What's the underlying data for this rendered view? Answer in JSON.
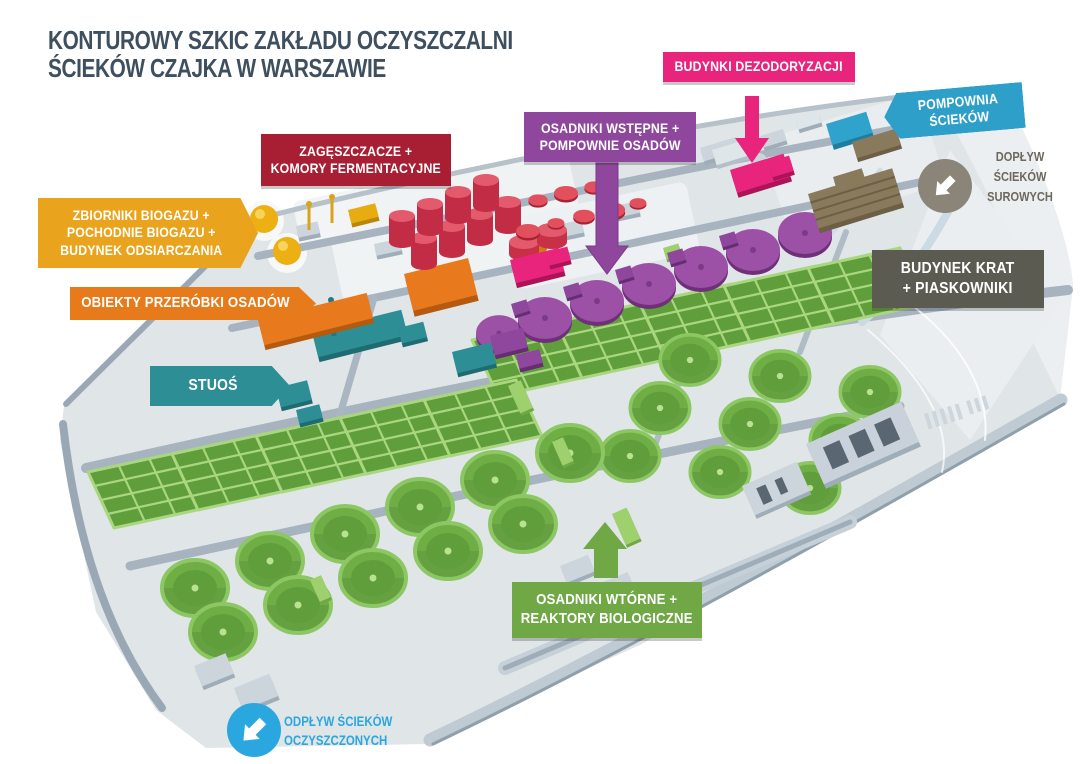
{
  "title": {
    "text": "KONTUROWY SZKIC ZAKŁADU OCZYSZCZALNI ŚCIEKÓW CZAJKA W WARSZAWIE",
    "lines": [
      "KONTUROWY SZKIC ZAKŁADU OCZYSZCZALNI",
      "ŚCIEKÓW CZAJKA W WARSZAWIE"
    ],
    "color": "#3e4f60"
  },
  "labels": {
    "dezodoryzacja": {
      "lines": [
        "BUDYNKI DEZODORYZACJI"
      ],
      "color": "#e8247c"
    },
    "pompownia": {
      "lines": [
        "POMPOWNIA",
        "ŚCIEKÓW"
      ],
      "color": "#2d9fc9"
    },
    "doplyw": {
      "lines": [
        "DOPŁYW",
        "ŚCIEKÓW",
        "SUROWYCH"
      ],
      "color": "#8b8478",
      "text_color": "#6e675c"
    },
    "osadniki_wstepne": {
      "lines": [
        "OSADNIKI WSTĘPNE +",
        "POMPOWNIE OSADÓW"
      ],
      "color": "#8f479e"
    },
    "zageszczacze": {
      "lines": [
        "ZAGĘSZCZACZE +",
        "KOMORY FERMENTACYJNE"
      ],
      "color": "#a81e33"
    },
    "zbiorniki": {
      "lines": [
        "ZBIORNIKI BIOGAZU +",
        "POCHODNIE BIOGAZU +",
        "BUDYNEK ODSIARCZANIA"
      ],
      "color": "#e9a31d"
    },
    "obiekty": {
      "lines": [
        "OBIEKTY PRZERÓBKI OSADÓW"
      ],
      "color": "#e77a1a"
    },
    "stuos": {
      "lines": [
        "STUOŚ"
      ],
      "color": "#2e8e96"
    },
    "budynek_krat": {
      "lines": [
        "BUDYNEK KRAT",
        "+ PIASKOWNIKI"
      ],
      "color": "#5c5b51"
    },
    "osadniki_wtorne": {
      "lines": [
        "OSADNIKI WTÓRNE +",
        "REAKTORY BIOLOGICZNE"
      ],
      "color": "#6fa845"
    },
    "odplyw": {
      "lines": [
        "ODPŁYW ŚCIEKÓW",
        "OCZYSZCZONYCH"
      ],
      "color": "#2aa7df"
    }
  },
  "map": {
    "colors": {
      "terrain": "#e0e5e8",
      "road": "#a7b4c0",
      "secondary_clarifier_green": "#6fae45",
      "bioreactor_green": "#5f9e3b",
      "primary_clarifier_purple": "#9c50a6",
      "digester_red": "#c22c45",
      "biogas_yellow": "#ecb013",
      "sludge_orange": "#e8791d",
      "stuos_teal": "#2e8e96",
      "screens_brown": "#8a7a5c",
      "pumping_blue": "#2fa3cc",
      "deodorization_magenta": "#e8247c"
    }
  }
}
